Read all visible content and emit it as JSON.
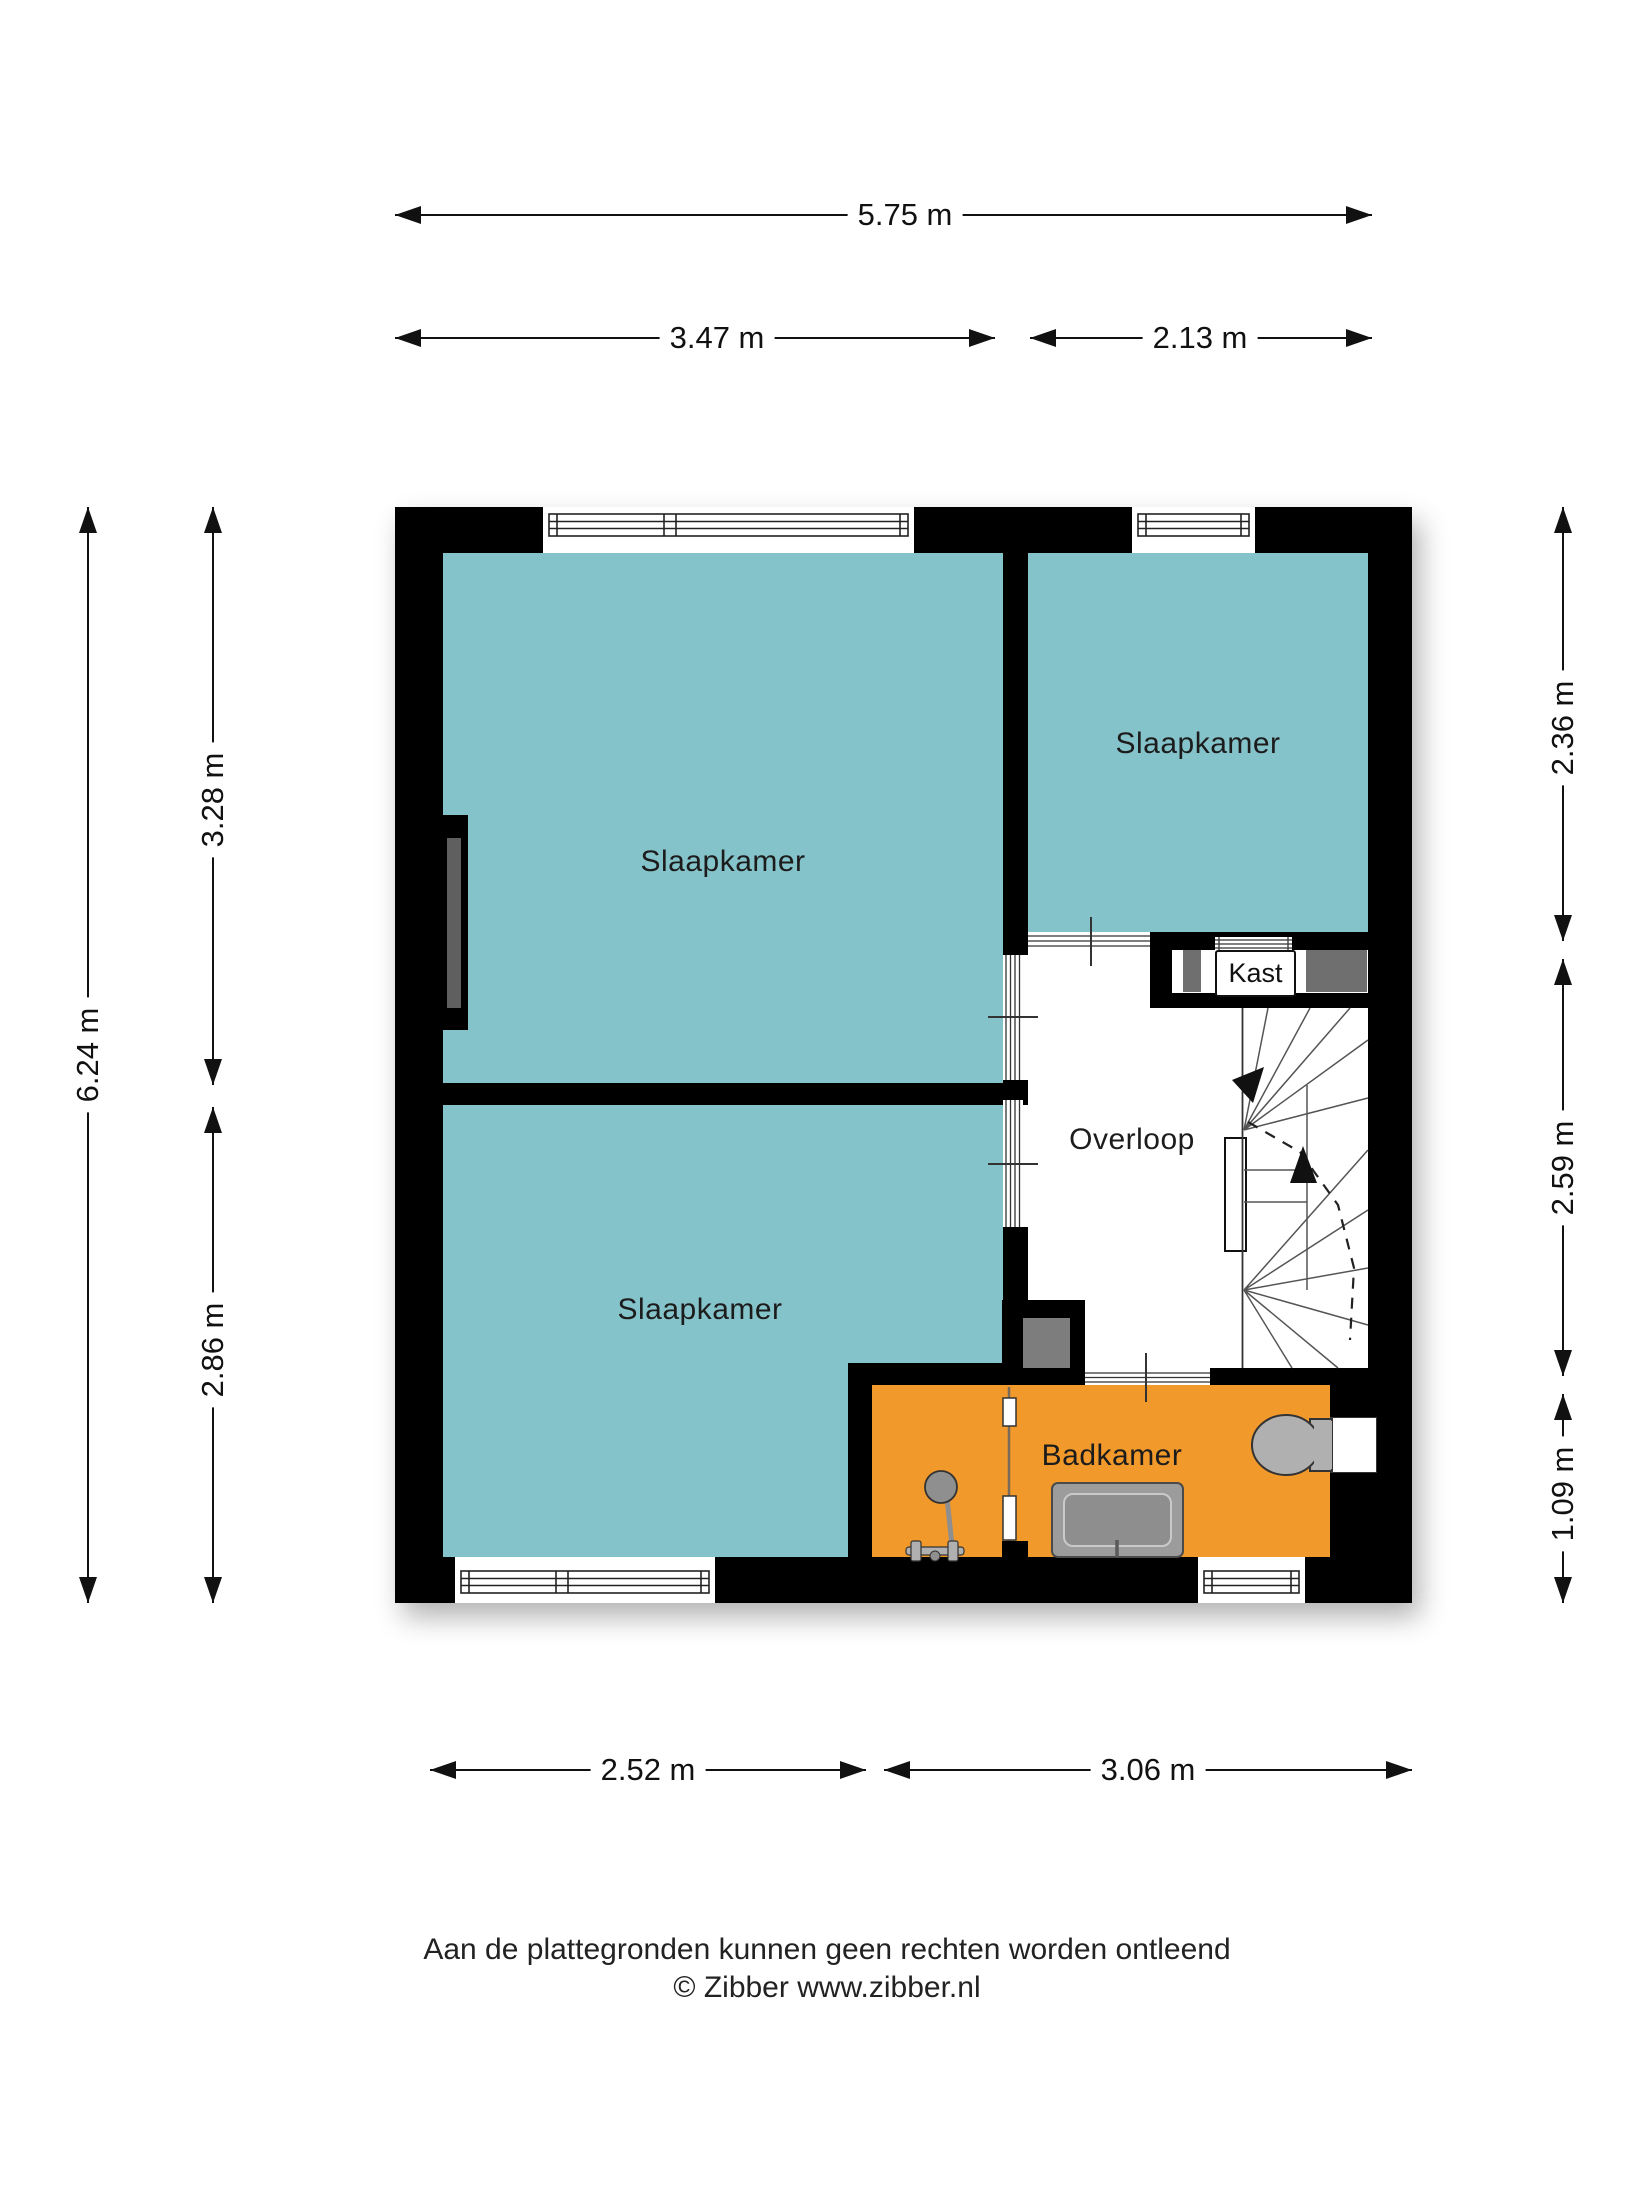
{
  "rooms": {
    "bedroom_tl": "Slaapkamer",
    "bedroom_tr": "Slaapkamer",
    "bedroom_bl": "Slaapkamer",
    "landing": "Overloop",
    "closet": "Kast",
    "bathroom": "Badkamer"
  },
  "dimensions": {
    "top_total": "5.75 m",
    "top_left": "3.47 m",
    "top_right": "2.13 m",
    "left_total": "6.24 m",
    "left_upper": "3.28 m",
    "left_lower": "2.86 m",
    "right_upper": "2.36 m",
    "right_middle": "2.59 m",
    "right_lower": "1.09 m",
    "bottom_left": "2.52 m",
    "bottom_right": "3.06 m"
  },
  "footer": {
    "disclaimer": "Aan de plattegronden kunnen geen rechten worden ontleend",
    "copyright": "© Zibber www.zibber.nl"
  },
  "colors": {
    "bedroom_teal": "#85c3cb",
    "bathroom_orange": "#f2992b",
    "wall_black": "#000000",
    "closet_gray": "#6f6f6f",
    "fixture_gray": "#a8a8a8"
  }
}
